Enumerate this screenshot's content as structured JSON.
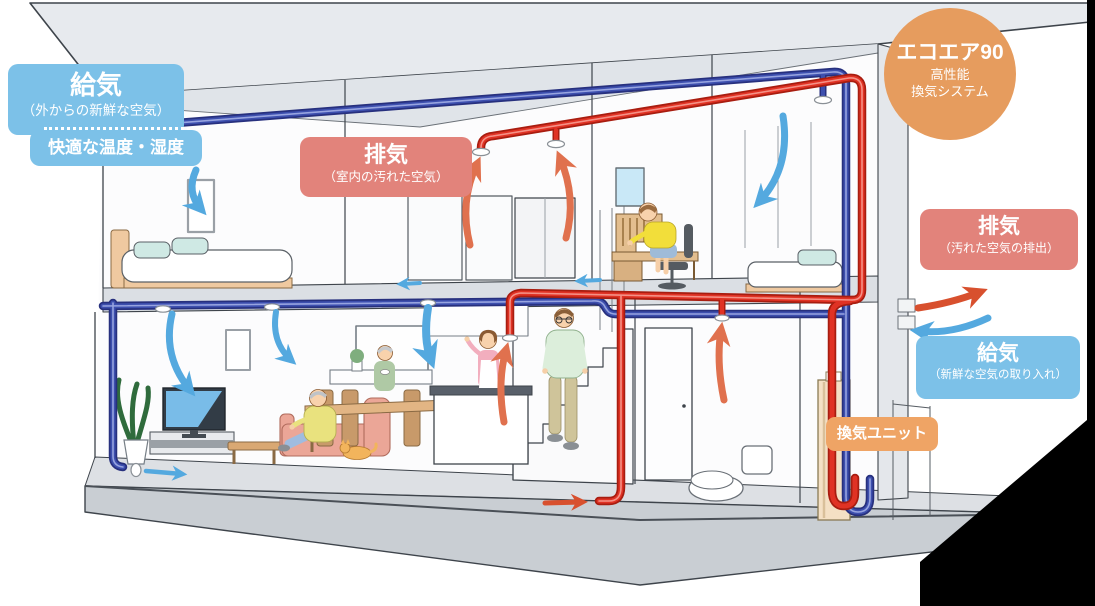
{
  "diagram": {
    "badge": {
      "title": "エコエア90",
      "subtitle_line1": "高性能",
      "subtitle_line2": "換気システム"
    },
    "labels": {
      "supply_top_title": "給気",
      "supply_top_sub": "（外からの新鮮な空気）",
      "supply_top_note": "快適な温度・湿度",
      "exhaust_indoor_title": "排気",
      "exhaust_indoor_sub": "（室内の汚れた空気）",
      "exhaust_outlet_title": "排気",
      "exhaust_outlet_sub": "（汚れた空気の排出）",
      "supply_intake_title": "給気",
      "supply_intake_sub": "（新鮮な空気の取り入れ）",
      "vent_unit": "換気ユニット"
    },
    "colors": {
      "supply_label": "#7CC1E8",
      "exhaust_label": "#E2837B",
      "badge": "#E69C5E",
      "unit_label": "#EFA465",
      "pipe_supply": "#3D4FAE",
      "pipe_exhaust": "#E03224",
      "arrow_supply": "#54A9DF",
      "arrow_exhaust": "#E0714E"
    }
  }
}
